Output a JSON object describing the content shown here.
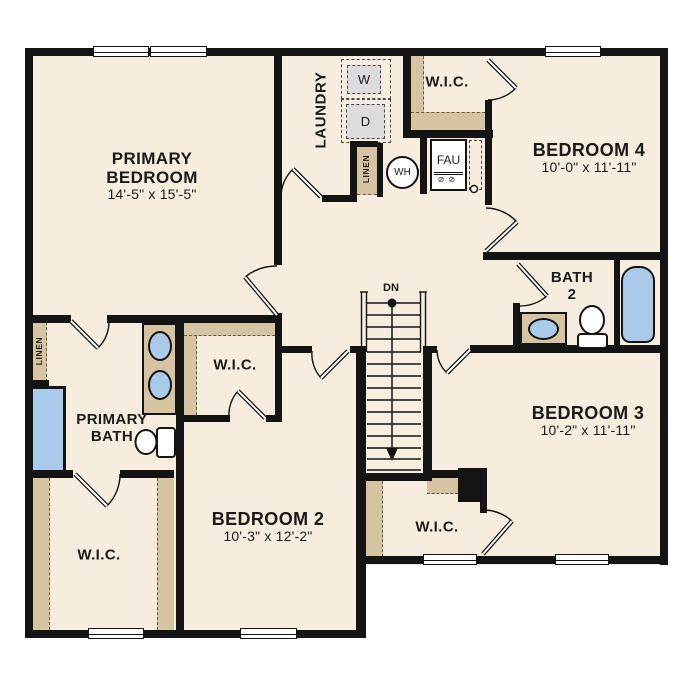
{
  "plan": {
    "type": "second-story floor plan",
    "floor_color": "#f6edde",
    "wall_color": "#141414",
    "accent_tan": "#d5c3a2",
    "fixture_blue": "#a9cbe9",
    "appliance_gray": "#dcdcdc"
  },
  "rooms": {
    "primary_bedroom": {
      "line1": "PRIMARY",
      "line2": "BEDROOM",
      "dims": "14'-5\" x 15'-5\""
    },
    "bedroom_2": {
      "name": "BEDROOM 2",
      "dims": "10'-3\" x 12'-2\""
    },
    "bedroom_3": {
      "name": "BEDROOM 3",
      "dims": "10'-2\" x 11'-11\""
    },
    "bedroom_4": {
      "name": "BEDROOM 4",
      "dims": "10'-0\" x 11'-11\""
    },
    "primary_bath": {
      "line1": "PRIMARY",
      "line2": "BATH"
    },
    "bath_2": {
      "line1": "BATH",
      "line2": "2"
    },
    "laundry": {
      "name": "LAUNDRY"
    }
  },
  "closets": {
    "wic": "W.I.C.",
    "linen": "LINEN"
  },
  "fixtures": {
    "washer": "W",
    "dryer": "D",
    "water_heater": "WH",
    "fau": "FAU"
  },
  "stairs": {
    "direction": "DN"
  }
}
